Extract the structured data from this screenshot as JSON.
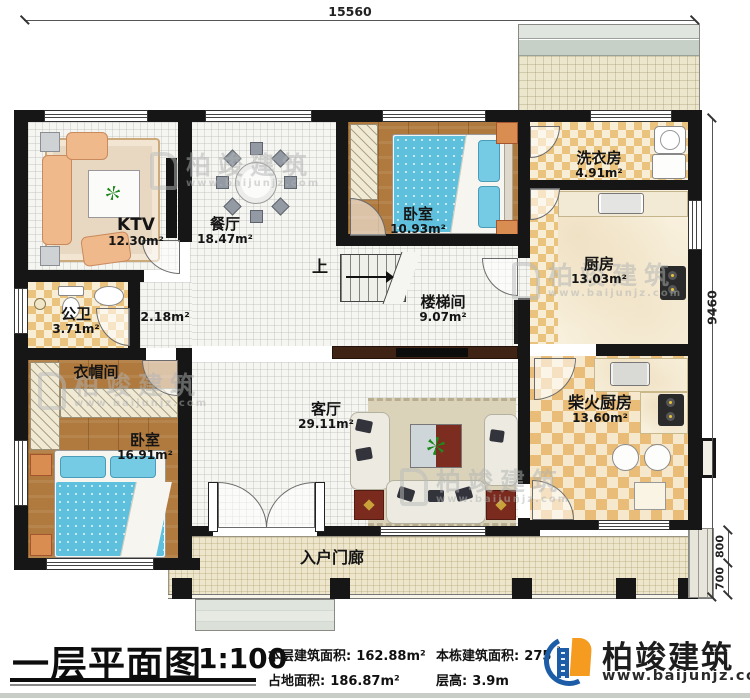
{
  "dims": {
    "top": "15560",
    "right": "9460",
    "step_a": "800",
    "step_b": "700"
  },
  "rooms": {
    "ktv": {
      "name": "KTV",
      "area": "12.30m²"
    },
    "dining": {
      "name": "餐厅",
      "area": "18.47m²"
    },
    "bedroom1": {
      "name": "卧室",
      "area": "10.93m²"
    },
    "laundry": {
      "name": "洗衣房",
      "area": "4.91m²"
    },
    "kitchen": {
      "name": "厨房",
      "area": "13.03m²"
    },
    "stair": {
      "name": "楼梯间",
      "area": "9.07m²"
    },
    "bath": {
      "name": "公卫",
      "area": "3.71m²"
    },
    "hall": {
      "area": "2.18m²"
    },
    "cloak": {
      "name": "衣帽间"
    },
    "bedroom2": {
      "name": "卧室",
      "area": "16.91m²"
    },
    "living": {
      "name": "客厅",
      "area": "29.11m²"
    },
    "firewood": {
      "name": "柴火厨房",
      "area": "13.60m²"
    },
    "porch": {
      "name": "入户门廊"
    },
    "up": "上"
  },
  "titleblock": {
    "title": "一层平面图",
    "scale": "1:100",
    "items": [
      {
        "label": "本层建筑面积:",
        "value": "162.88m²"
      },
      {
        "label": "本栋建筑面积:",
        "value": "275",
        "sup": "²"
      },
      {
        "label": "占地面积:",
        "value": "186.87m²"
      },
      {
        "label": "层高:",
        "value": "3.9m"
      }
    ]
  },
  "brand": {
    "name": "柏竣建筑",
    "site": "www.baijunjz.com"
  },
  "watermark": {
    "name": "柏竣建筑",
    "site": "www.baijunjz.com"
  },
  "colors": {
    "wall": "#161616",
    "blue": "#1d5ca6",
    "orange": "#f59b20"
  }
}
